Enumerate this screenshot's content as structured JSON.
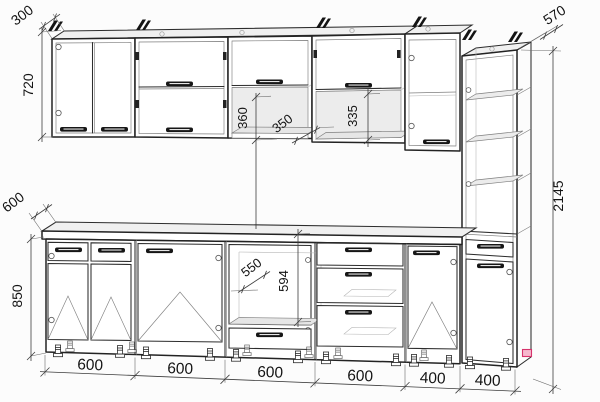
{
  "meta": {
    "title": "Kitchen cabinet set - technical elevation drawing",
    "units": "mm"
  },
  "dims": {
    "wall_depth": "300",
    "wall_height": "720",
    "upper_open_height": "360",
    "upper_shelf_depth": "350",
    "upper_niche_height": "335",
    "tall_depth": "570",
    "counter_depth": "600",
    "base_height": "850",
    "oven_niche_width": "550",
    "oven_niche_height": "594",
    "total_height": "2145",
    "widths": [
      "600",
      "600",
      "600",
      "600",
      "400",
      "400"
    ]
  },
  "colors": {
    "line": "#2d2d2d",
    "background": "#fcfcfc",
    "marker": "#d6336c"
  }
}
